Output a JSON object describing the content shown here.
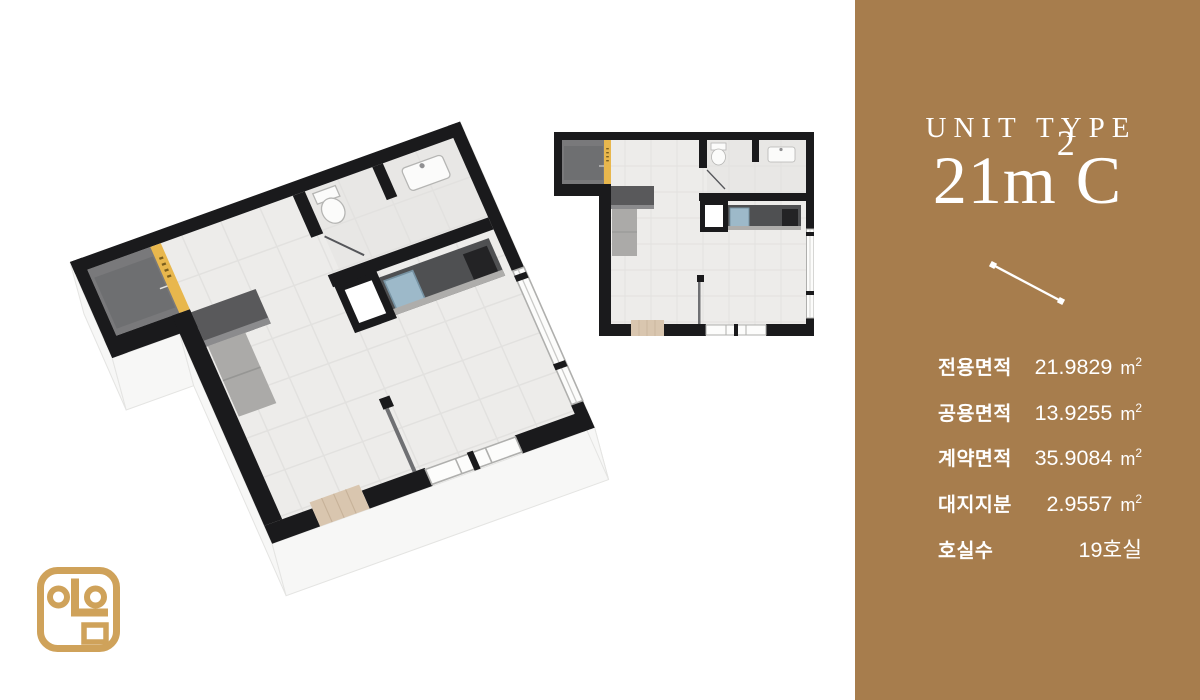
{
  "colors": {
    "panel-brown": "#A77D4D",
    "logo-gold": "#CFA25A",
    "accent-yellow": "#E8B74D",
    "wall-black": "#1A1A1C",
    "floor-gray": "#EDECEA",
    "text-white": "#FFFFFF"
  },
  "panel": {
    "unit_type_label": "UNIT TYPE",
    "unit_code": {
      "prefix": "21m",
      "sup": "2",
      "suffix": "C"
    },
    "specs": [
      {
        "label": "전용면적",
        "value": "21.9829",
        "unit_base": "m",
        "unit_sup": "2"
      },
      {
        "label": "공용면적",
        "value": "13.9255",
        "unit_base": "m",
        "unit_sup": "2"
      },
      {
        "label": "계약면적",
        "value": "35.9084",
        "unit_base": "m",
        "unit_sup": "2"
      },
      {
        "label": "대지지분",
        "value": "2.9557",
        "unit_base": "m",
        "unit_sup": "2"
      },
      {
        "label": "호실수",
        "value": "19호실",
        "unit_base": null,
        "unit_sup": null
      }
    ]
  }
}
